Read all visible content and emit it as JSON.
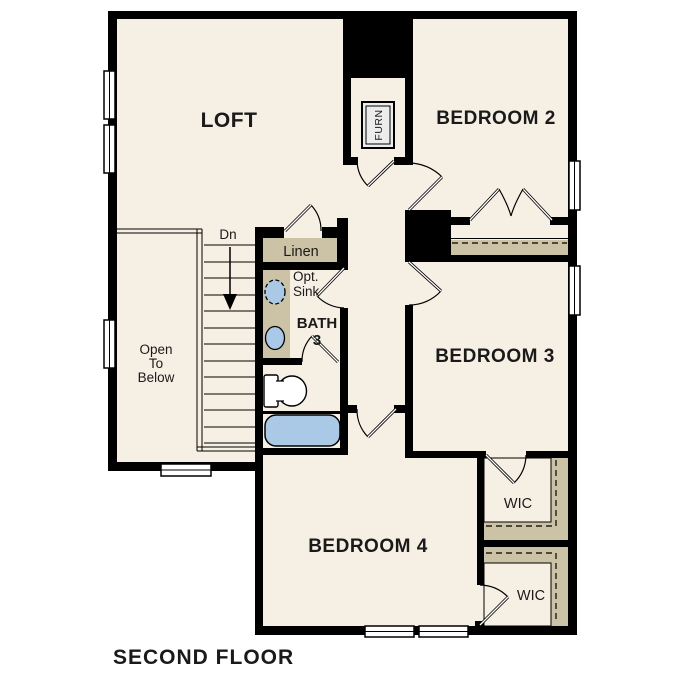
{
  "floor_title": "SECOND FLOOR",
  "rooms": {
    "loft": {
      "label": "LOFT"
    },
    "bedroom_2": {
      "label": "BEDROOM 2"
    },
    "bedroom_3": {
      "label": "BEDROOM 3"
    },
    "bedroom_4": {
      "label": "BEDROOM 4"
    },
    "bath_3": {
      "label_line1": "BATH",
      "label_line2": "3"
    },
    "linen_closet": {
      "label": "Linen"
    },
    "walk_in_closet_1": {
      "label": "WIC"
    },
    "walk_in_closet_2": {
      "label": "WIC"
    },
    "furnace_closet": {
      "label": "FURN"
    },
    "open_to_below": {
      "label_line1": "Open",
      "label_line2": "To",
      "label_line3": "Below"
    },
    "stairs": {
      "direction_label": "Dn"
    }
  },
  "annotations": {
    "optional_sink": {
      "label_line1": "Opt.",
      "label_line2": "Sink"
    }
  },
  "colors": {
    "background": "#ffffff",
    "floor": "#f6efe3",
    "wall": "#000000",
    "shelf_tan": "#ccc2a5",
    "plumbing_blue": "#a9c9e6",
    "furnace_box": "#ececec",
    "text": "#1a1a1a"
  }
}
